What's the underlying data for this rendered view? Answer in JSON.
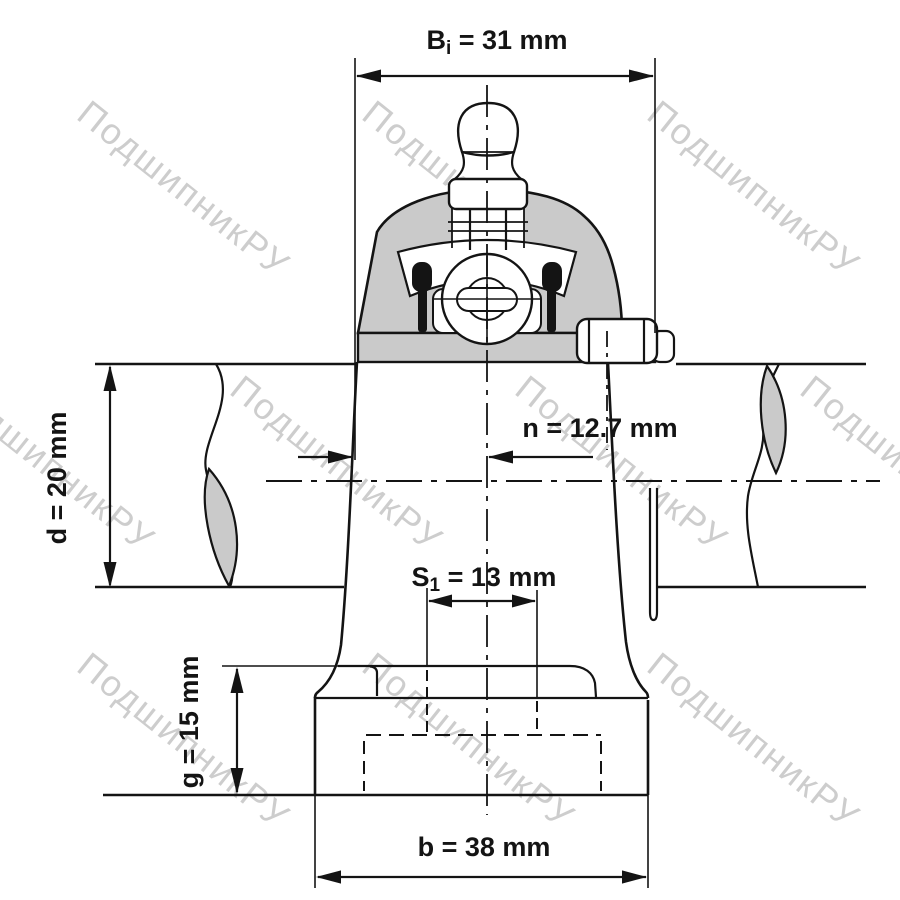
{
  "title": "Pillow block bearing unit – dimensional drawing, front sectional view",
  "watermark": {
    "text": "ПодшипникРУ",
    "color": "#cdcdcd"
  },
  "dimensions": {
    "Bi": {
      "base": "B",
      "sub": "i",
      "rest": " = 31 mm",
      "meaning": "inner ring width"
    },
    "d": {
      "text": "d = 20 mm",
      "meaning": "shaft diameter"
    },
    "n": {
      "text": "n = 12.7 mm",
      "meaning": "center plane to inner ring face"
    },
    "S1": {
      "base": "S",
      "sub": "1",
      "rest": " = 13 mm",
      "meaning": "bolt slot width"
    },
    "g": {
      "text": "g = 15 mm",
      "meaning": "base height"
    },
    "b": {
      "text": "b = 38 mm",
      "meaning": "base width"
    }
  },
  "drawing": {
    "type": "technical-diagram",
    "component": "pillow block ball bearing unit with grease nipple, set screw and shaft",
    "colors": {
      "line": "#141414",
      "section_fill": "#cacaca",
      "background": "#ffffff",
      "watermark": "#cdcdcd"
    }
  }
}
